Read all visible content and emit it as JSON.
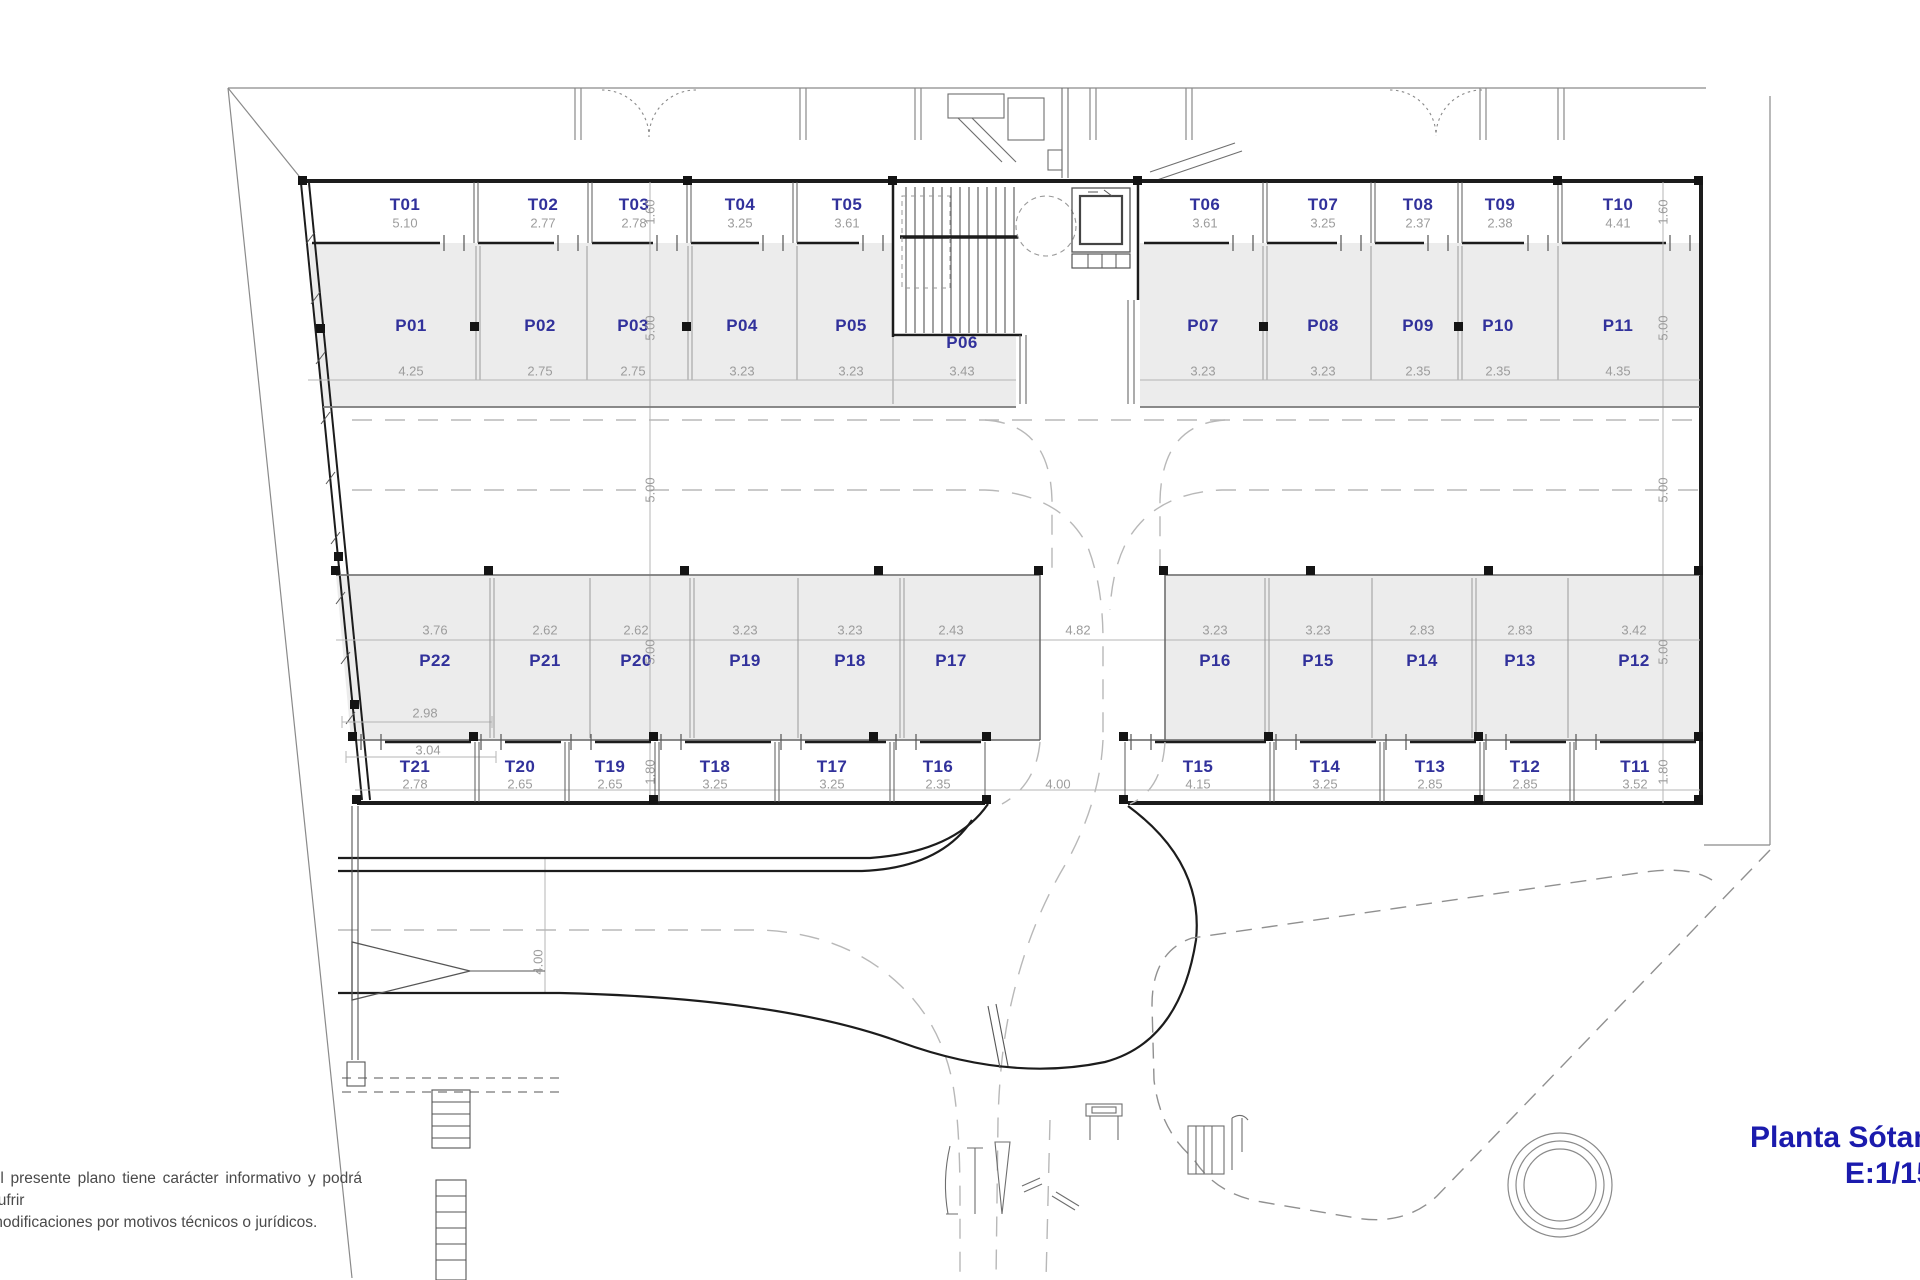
{
  "plan": {
    "title": {
      "line1": "Planta Sótano",
      "line2": "E:1/150"
    },
    "disclaimer": {
      "line1": "El presente plano tiene carácter informativo y podrá sufrir",
      "line2": "modificaciones por motivos técnicos o jurídicos."
    },
    "storage_top": [
      {
        "id": "T01",
        "w": "5.10"
      },
      {
        "id": "T02",
        "w": "2.77"
      },
      {
        "id": "T03",
        "w": "2.78"
      },
      {
        "id": "T04",
        "w": "3.25"
      },
      {
        "id": "T05",
        "w": "3.61"
      },
      {
        "id": "T06",
        "w": "3.61"
      },
      {
        "id": "T07",
        "w": "3.25"
      },
      {
        "id": "T08",
        "w": "2.37"
      },
      {
        "id": "T09",
        "w": "2.38"
      },
      {
        "id": "T10",
        "w": "4.41"
      }
    ],
    "parking_top": [
      {
        "id": "P01",
        "w": "4.25"
      },
      {
        "id": "P02",
        "w": "2.75"
      },
      {
        "id": "P03",
        "w": "2.75"
      },
      {
        "id": "P04",
        "w": "3.23"
      },
      {
        "id": "P05",
        "w": "3.23"
      },
      {
        "id": "P06",
        "w": "3.43"
      },
      {
        "id": "P07",
        "w": "3.23"
      },
      {
        "id": "P08",
        "w": "3.23"
      },
      {
        "id": "P09",
        "w": "2.35"
      },
      {
        "id": "P10",
        "w": "2.35"
      },
      {
        "id": "P11",
        "w": "4.35"
      }
    ],
    "parking_bottom": [
      {
        "id": "P22",
        "w": "3.76"
      },
      {
        "id": "P21",
        "w": "2.62"
      },
      {
        "id": "P20",
        "w": "2.62"
      },
      {
        "id": "P19",
        "w": "3.23"
      },
      {
        "id": "P18",
        "w": "3.23"
      },
      {
        "id": "P17",
        "w": "2.43"
      },
      {
        "id": "P16",
        "w": "3.23"
      },
      {
        "id": "P15",
        "w": "3.23"
      },
      {
        "id": "P14",
        "w": "2.83"
      },
      {
        "id": "P13",
        "w": "2.83"
      },
      {
        "id": "P12",
        "w": "3.42"
      }
    ],
    "storage_bottom": [
      {
        "id": "T21",
        "w": "2.78"
      },
      {
        "id": "T20",
        "w": "2.65"
      },
      {
        "id": "T19",
        "w": "2.65"
      },
      {
        "id": "T18",
        "w": "3.25"
      },
      {
        "id": "T17",
        "w": "3.25"
      },
      {
        "id": "T16",
        "w": "2.35"
      },
      {
        "id": "T15",
        "w": "4.15"
      },
      {
        "id": "T14",
        "w": "3.25"
      },
      {
        "id": "T13",
        "w": "2.85"
      },
      {
        "id": "T12",
        "w": "2.85"
      },
      {
        "id": "T11",
        "w": "3.52"
      }
    ],
    "side_dims_left": [
      "1.60",
      "5.00",
      "5.00",
      "5.00",
      "1.80"
    ],
    "side_dims_right": [
      "1.60",
      "5.00",
      "5.00",
      "5.00",
      "1.80"
    ],
    "aux_dims": {
      "p22_depth": "2.98",
      "t21_top": "3.04",
      "center_road": "4.82",
      "bottom_road": "4.00",
      "ramp_width": "4.00"
    },
    "colors": {
      "unit_label": "#31319b",
      "dim_text": "#9c9c9c",
      "title": "#1b1bad",
      "stall_fill": "#ececec"
    }
  }
}
